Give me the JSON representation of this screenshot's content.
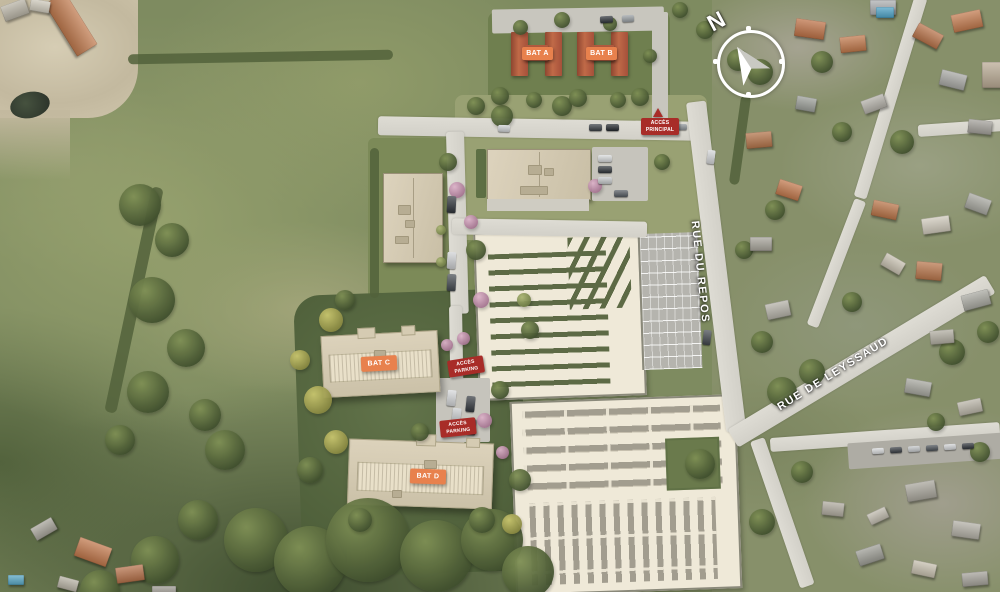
{
  "compass": {
    "north_label": "N"
  },
  "streets": [
    {
      "name": "RUE DU REPOS"
    },
    {
      "name": "RUE DE LEYSSAUD"
    }
  ],
  "buildings": [
    {
      "label": "BAT A"
    },
    {
      "label": "BAT B"
    },
    {
      "label": "BAT C"
    },
    {
      "label": "BAT D"
    }
  ],
  "access_points": [
    {
      "line1": "ACCÈS",
      "line2": "PRINCIPAL"
    },
    {
      "line1": "ACCÈS",
      "line2": "PARKING"
    },
    {
      "line1": "ACCÈS",
      "line2": "PARKING"
    }
  ],
  "icons": {
    "north_arrow": "north-arrow",
    "access_warning": "warning-triangle"
  },
  "colors": {
    "building_label_bg": "#e8814d",
    "access_label_bg": "#a82c28",
    "label_text": "#ffffff",
    "roof_terracotta": "#b35b3f",
    "building_roof_beige": "#d9cfb8",
    "road_gray": "#d7d5cd",
    "field_green": "#7e8b60",
    "cemetery_ground": "#efe9d8",
    "hedge_green": "#5d6a45",
    "parking_asphalt": "#b5b4ae",
    "pool_blue": "#4fa3c7"
  }
}
